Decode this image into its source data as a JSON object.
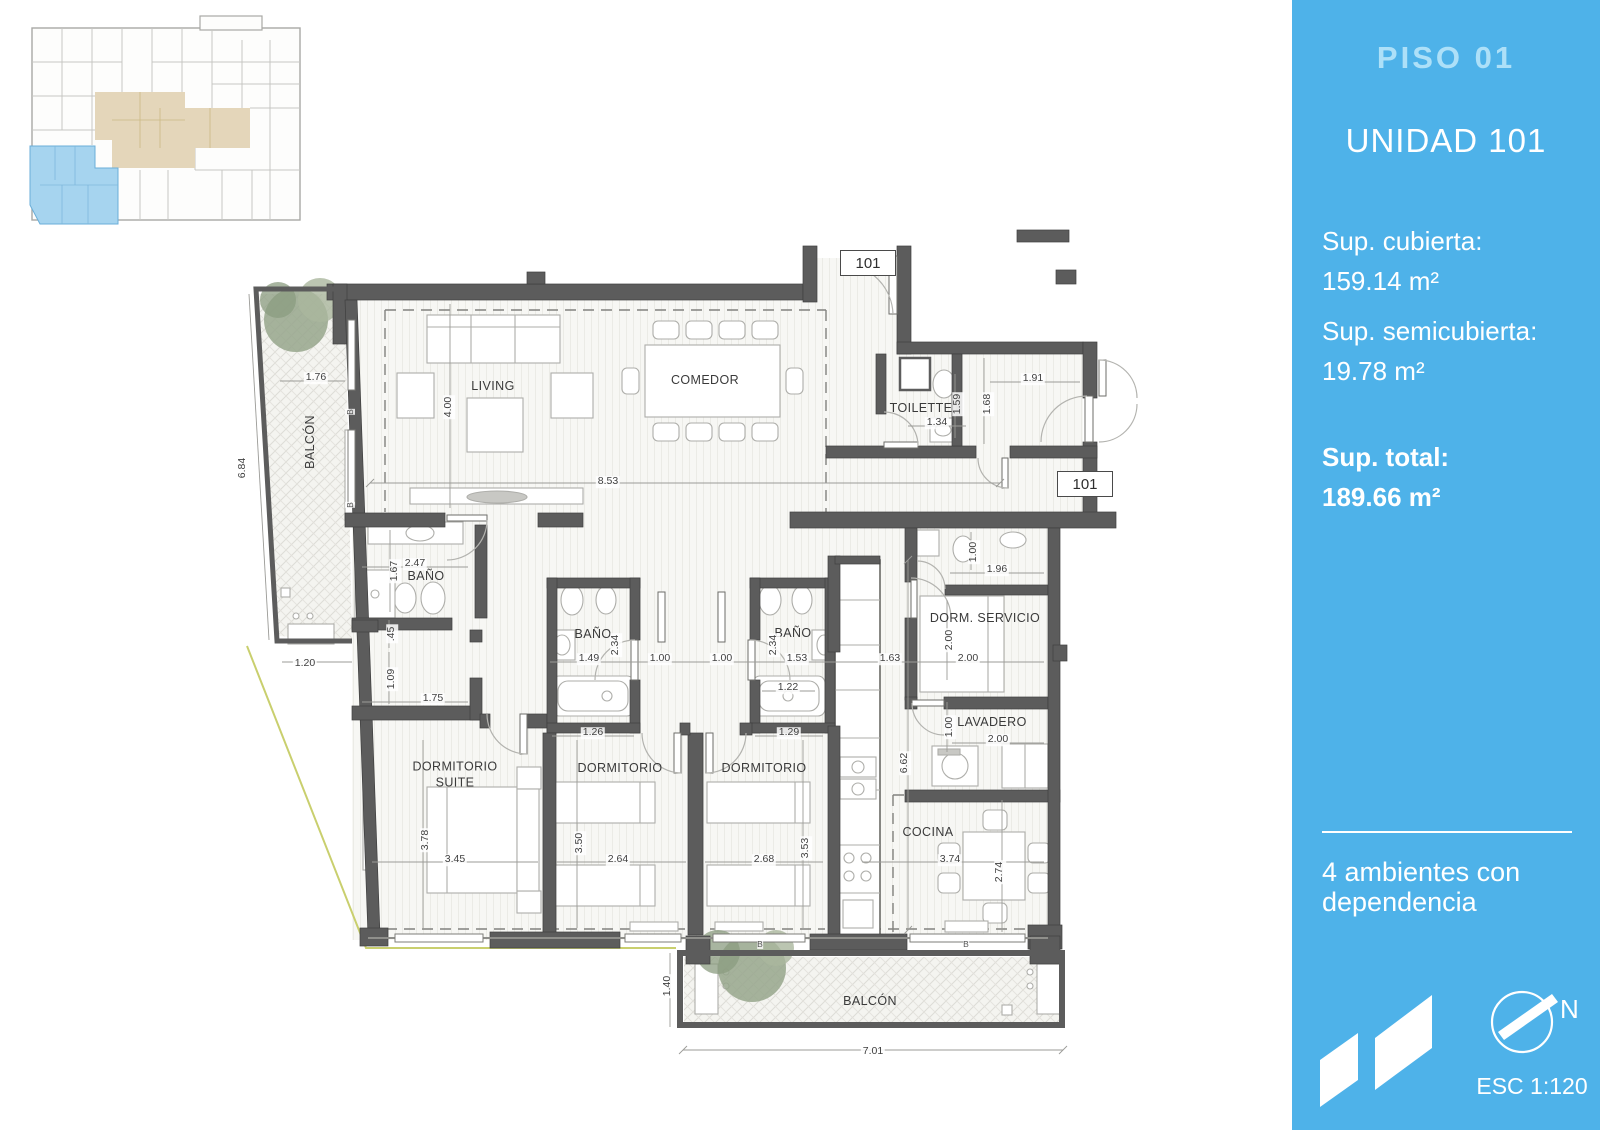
{
  "sidebar": {
    "title": "PISO 01",
    "unit": "UNIDAD 101",
    "areas": [
      {
        "label": "Sup. cubierta:",
        "value": "159.14 m²"
      },
      {
        "label": "Sup. semicubierta:",
        "value": "19.78 m²"
      },
      {
        "label": "Sup. total:",
        "value": "189.66 m²"
      }
    ],
    "description": "4 ambientes con dependencia",
    "north_label": "N",
    "scale_label": "ESC 1:120",
    "colors": {
      "background": "#4eb2e9",
      "title": "#ade0f8",
      "text": "#ffffff"
    }
  },
  "key_plan": {
    "highlight_unit_color": "#a6d4ef",
    "common_area_color": "#e4d6ba"
  },
  "plan": {
    "unit_tags": [
      "101",
      "101"
    ],
    "rooms": [
      {
        "label": "LIVING",
        "x": 493,
        "y": 386,
        "rot": 0,
        "wrap": false
      },
      {
        "label": "COMEDOR",
        "x": 705,
        "y": 380,
        "rot": 0,
        "wrap": false
      },
      {
        "label": "TOILETTE",
        "x": 921,
        "y": 408,
        "rot": 0,
        "wrap": false
      },
      {
        "label": "BAÑO",
        "x": 426,
        "y": 576,
        "rot": 0,
        "wrap": false
      },
      {
        "label": "BAÑO",
        "x": 593,
        "y": 634,
        "rot": 0,
        "wrap": false
      },
      {
        "label": "BAÑO",
        "x": 793,
        "y": 633,
        "rot": 0,
        "wrap": false
      },
      {
        "label": "DORM. SERVICIO",
        "x": 985,
        "y": 618,
        "rot": 0,
        "wrap": false
      },
      {
        "label": "LAVADERO",
        "x": 992,
        "y": 722,
        "rot": 0,
        "wrap": false
      },
      {
        "label": "DORMITORIO SUITE",
        "x": 455,
        "y": 775,
        "rot": 0,
        "wrap": true
      },
      {
        "label": "DORMITORIO",
        "x": 620,
        "y": 768,
        "rot": 0,
        "wrap": false
      },
      {
        "label": "DORMITORIO",
        "x": 764,
        "y": 768,
        "rot": 0,
        "wrap": false
      },
      {
        "label": "COCINA",
        "x": 928,
        "y": 832,
        "rot": 0,
        "wrap": false
      },
      {
        "label": "BALCÓN",
        "x": 310,
        "y": 442,
        "rot": 90,
        "wrap": false
      },
      {
        "label": "BALCÓN",
        "x": 870,
        "y": 1001,
        "rot": 0,
        "wrap": false
      }
    ],
    "dimensions": [
      {
        "label": "1.76",
        "x": 316,
        "y": 378,
        "rot": 0
      },
      {
        "label": "6.84",
        "x": 243,
        "y": 468,
        "rot": 90
      },
      {
        "label": "1.20",
        "x": 305,
        "y": 664,
        "rot": 0
      },
      {
        "label": "4.00",
        "x": 449,
        "y": 407,
        "rot": 90
      },
      {
        "label": "8.53",
        "x": 608,
        "y": 482,
        "rot": 0
      },
      {
        "label": "1.91",
        "x": 1033,
        "y": 379,
        "rot": 0
      },
      {
        "label": "1.34",
        "x": 937,
        "y": 423,
        "rot": 0
      },
      {
        "label": "1.59",
        "x": 958,
        "y": 404,
        "rot": 90
      },
      {
        "label": "1.68",
        "x": 988,
        "y": 404,
        "rot": 90
      },
      {
        "label": "2.47",
        "x": 415,
        "y": 564,
        "rot": 0
      },
      {
        "label": "1.67",
        "x": 395,
        "y": 571,
        "rot": 90
      },
      {
        "label": ".45",
        "x": 392,
        "y": 634,
        "rot": 90
      },
      {
        "label": "1.09",
        "x": 392,
        "y": 679,
        "rot": 90
      },
      {
        "label": "1.75",
        "x": 433,
        "y": 699,
        "rot": 0
      },
      {
        "label": "1.49",
        "x": 589,
        "y": 659,
        "rot": 0
      },
      {
        "label": "2.34",
        "x": 616,
        "y": 645,
        "rot": 90
      },
      {
        "label": "1.00",
        "x": 660,
        "y": 659,
        "rot": 0
      },
      {
        "label": "1.26",
        "x": 593,
        "y": 733,
        "rot": 0
      },
      {
        "label": "1.00",
        "x": 722,
        "y": 659,
        "rot": 0
      },
      {
        "label": "2.34",
        "x": 774,
        "y": 645,
        "rot": 90
      },
      {
        "label": "1.53",
        "x": 797,
        "y": 659,
        "rot": 0
      },
      {
        "label": "1.22",
        "x": 788,
        "y": 688,
        "rot": 0
      },
      {
        "label": "1.29",
        "x": 789,
        "y": 733,
        "rot": 0
      },
      {
        "label": "1.63",
        "x": 890,
        "y": 659,
        "rot": 0
      },
      {
        "label": "1.00",
        "x": 974,
        "y": 552,
        "rot": 90
      },
      {
        "label": "1.96",
        "x": 997,
        "y": 570,
        "rot": 0
      },
      {
        "label": "2.00",
        "x": 950,
        "y": 640,
        "rot": 90
      },
      {
        "label": "2.00",
        "x": 968,
        "y": 659,
        "rot": 0
      },
      {
        "label": "1.00",
        "x": 950,
        "y": 727,
        "rot": 90
      },
      {
        "label": "2.00",
        "x": 998,
        "y": 740,
        "rot": 0
      },
      {
        "label": "3.78",
        "x": 426,
        "y": 840,
        "rot": 90
      },
      {
        "label": "3.45",
        "x": 455,
        "y": 860,
        "rot": 0
      },
      {
        "label": "3.50",
        "x": 580,
        "y": 843,
        "rot": 90
      },
      {
        "label": "2.64",
        "x": 618,
        "y": 860,
        "rot": 0
      },
      {
        "label": "2.68",
        "x": 764,
        "y": 860,
        "rot": 0
      },
      {
        "label": "3.53",
        "x": 806,
        "y": 848,
        "rot": 90
      },
      {
        "label": "3.74",
        "x": 950,
        "y": 860,
        "rot": 0
      },
      {
        "label": "2.74",
        "x": 1000,
        "y": 872,
        "rot": 90
      },
      {
        "label": "6.62",
        "x": 905,
        "y": 763,
        "rot": 90
      },
      {
        "label": "1.40",
        "x": 668,
        "y": 986,
        "rot": 90
      },
      {
        "label": "7.01",
        "x": 873,
        "y": 1052,
        "rot": 0
      }
    ],
    "window_tags": [
      {
        "label": "B",
        "x": 350,
        "y": 412,
        "rot": 90
      },
      {
        "label": "B",
        "x": 350,
        "y": 505,
        "rot": 90
      },
      {
        "label": "B",
        "x": 760,
        "y": 944,
        "rot": 0
      },
      {
        "label": "B",
        "x": 966,
        "y": 944,
        "rot": 0
      }
    ]
  }
}
